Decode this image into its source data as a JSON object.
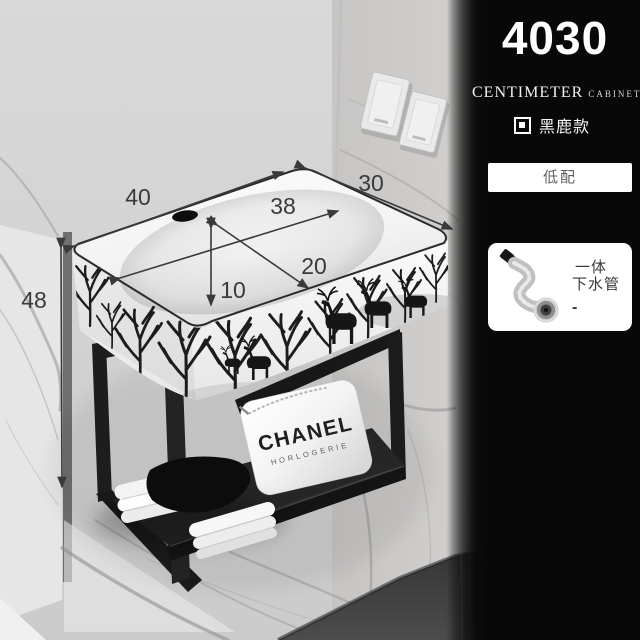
{
  "photo": {
    "dimension_labels": {
      "top_width": "40",
      "top_depth": "30",
      "inner_width": "38",
      "inner_depth": "20",
      "inner_height": "10",
      "mount_height": "48"
    },
    "branding": {
      "logo": "CHANEL",
      "logo_sub": "HORLOGERIE"
    }
  },
  "panel": {
    "model_number": "4030",
    "unit_word": "CENTIMETER",
    "category_word": "CABINET",
    "variant_label": "黑鹿款",
    "config_option": "低配",
    "accessory": {
      "line1": "一体",
      "line2": "下水管",
      "dash": "-"
    },
    "colors": {
      "panel_bg": "#0a0a0a",
      "panel_text": "#ffffff",
      "option_bg": "#ffffff",
      "option_text": "#5f5f5f",
      "dimension_text": "#3a3a3a"
    }
  }
}
